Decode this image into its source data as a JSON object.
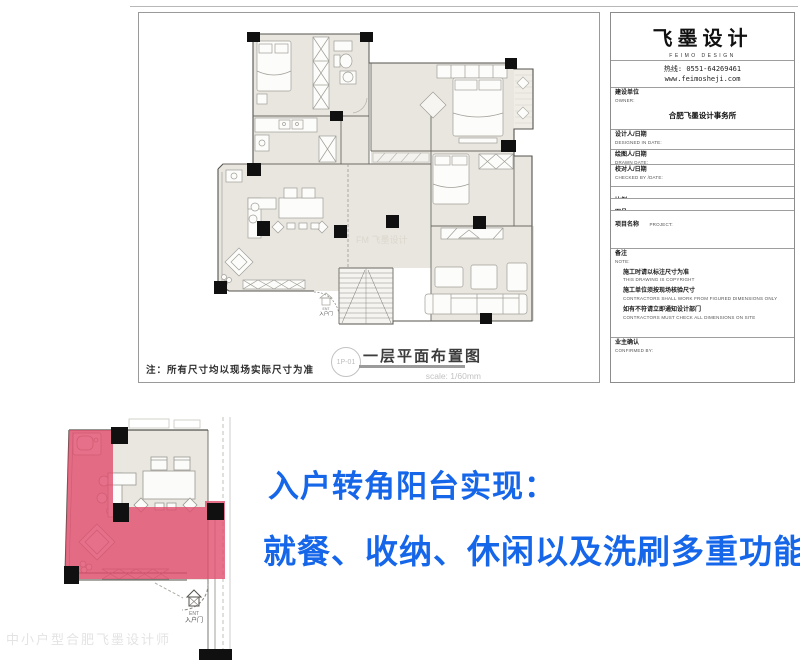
{
  "title_block": {
    "logo": "飞墨设计",
    "logo_en": "FEIMO DESIGN",
    "hotline": "热线: 0551-64269461",
    "website": "www.feimosheji.com",
    "rows": [
      {
        "zh": "建设单位",
        "en": "OWNER:",
        "value": "合肥飞墨设计事务所"
      },
      {
        "zh": "设计人/日期",
        "en": "DESIGNED IN DATE:"
      },
      {
        "zh": "绘图人/日期",
        "en": "DRAWN DATE:"
      },
      {
        "zh": "校对人/日期",
        "en": "CHECKED BY /DATE:"
      },
      {
        "zh": "比例",
        "en": "SCALE:"
      },
      {
        "zh": "图号",
        "en": "DRAWING NO."
      },
      {
        "zh": "项目名称",
        "en": "PROJECT:"
      }
    ],
    "note_zh": "备注",
    "note_en": "NOTE:",
    "notes": [
      {
        "zh": "施工时请以标注尺寸为准",
        "en": "THIS DRAWING IS COPYRIGHT"
      },
      {
        "zh": "施工单位须按现场核验尺寸",
        "en": "CONTRACTORS SHALL WORK FROM FIGURED DIMENSIONS ONLY"
      },
      {
        "zh": "如有不符请立即通知设计部门",
        "en": "CONTRACTORS MUST CHECK ALL DIMENSIONS ON SITE"
      }
    ],
    "confirm_zh": "业主确认",
    "confirm_en": "CONFIRMED BY:"
  },
  "drawing": {
    "title": "一层平面布置图",
    "drawing_code": "1P-01",
    "scale_text": "scale:  1/60mm",
    "note": "注：所有尺寸均以现场实际尺寸为准",
    "entry_label_en": "ENT",
    "entry_label": "入户门",
    "plan_watermark": "FM 飞墨设计"
  },
  "callout": {
    "line1": "入户转角阳台实现：",
    "line2": "就餐、收纳、休闲以及洗刷多重功能",
    "color": "#1566e9"
  },
  "watermark": "中小户型合肥飞墨设计师",
  "colors": {
    "highlight_red": "#e14e6d",
    "room_fill": "#e8e6df",
    "wall": "#55534e"
  }
}
